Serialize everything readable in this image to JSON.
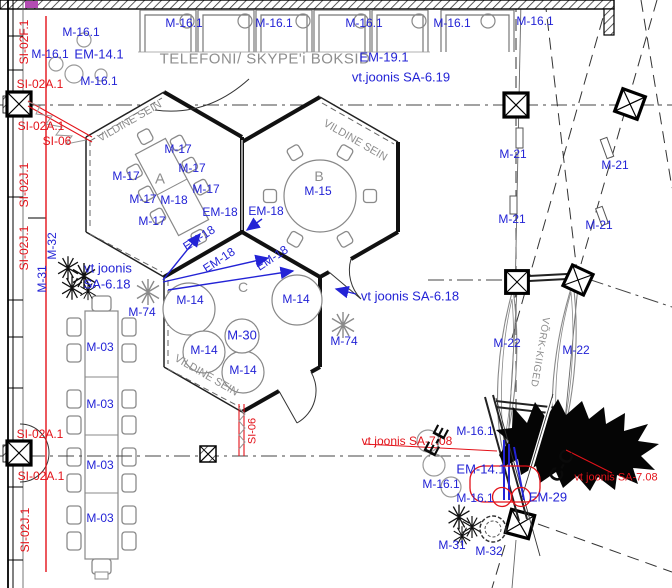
{
  "palette": {
    "annotation_blue": "#2323d6",
    "annotation_red": "#e31219",
    "drawing_gray": "#8e8e8e",
    "line_black": "#1a1a1a",
    "marker_purple": "#b34bb3"
  },
  "labels": [
    "M-16.1",
    "M-16.1",
    "M-16.1",
    "M-16.1",
    "M-16.1",
    "TELEFONI/ SKYPE'i BOKSID",
    "EM-19.1",
    "vt.joonis SA-6.19",
    "M-16.1",
    "M-16.1",
    "EM-14.1",
    "SI-02A.1",
    "M-16.1",
    "SI-02A.1",
    "SI-06",
    "SI-02F.1",
    "SI-02J.1",
    "SI-02J.1",
    "M-32",
    "M-31",
    "VILDINE SEIN",
    "M-17",
    "M-17",
    "M-17",
    "M-17",
    "M-17",
    "M-18",
    "M-17",
    "A",
    "EM-18",
    "EM-18",
    "EM-18",
    "EM-18",
    "EM-18",
    "vt joonis",
    "SA-6.18",
    "VILDINE SEIN",
    "B",
    "M-15",
    "C",
    "M-14",
    "M-14",
    "M-30",
    "M-14",
    "M-14",
    "VILDINE SEIN",
    "M-74",
    "M-74",
    "vt joonis SA-6.18",
    "M-03",
    "M-03",
    "M-03",
    "M-03",
    "SI-02A.1",
    "SI-02A.1",
    "SI-02J.1",
    "SI-06",
    "M-21",
    "M-21",
    "M-21",
    "M-21",
    "M-22",
    "M-22",
    "VÕRK-KIIGED",
    "vt joonis SA-7.08",
    "M-16.1",
    "EM-14.1",
    "M-16.1",
    "M-16.1",
    "EM-29",
    "vt joonis SA-7.08",
    "M-31",
    "M-32",
    "E-E",
    "C-C"
  ]
}
